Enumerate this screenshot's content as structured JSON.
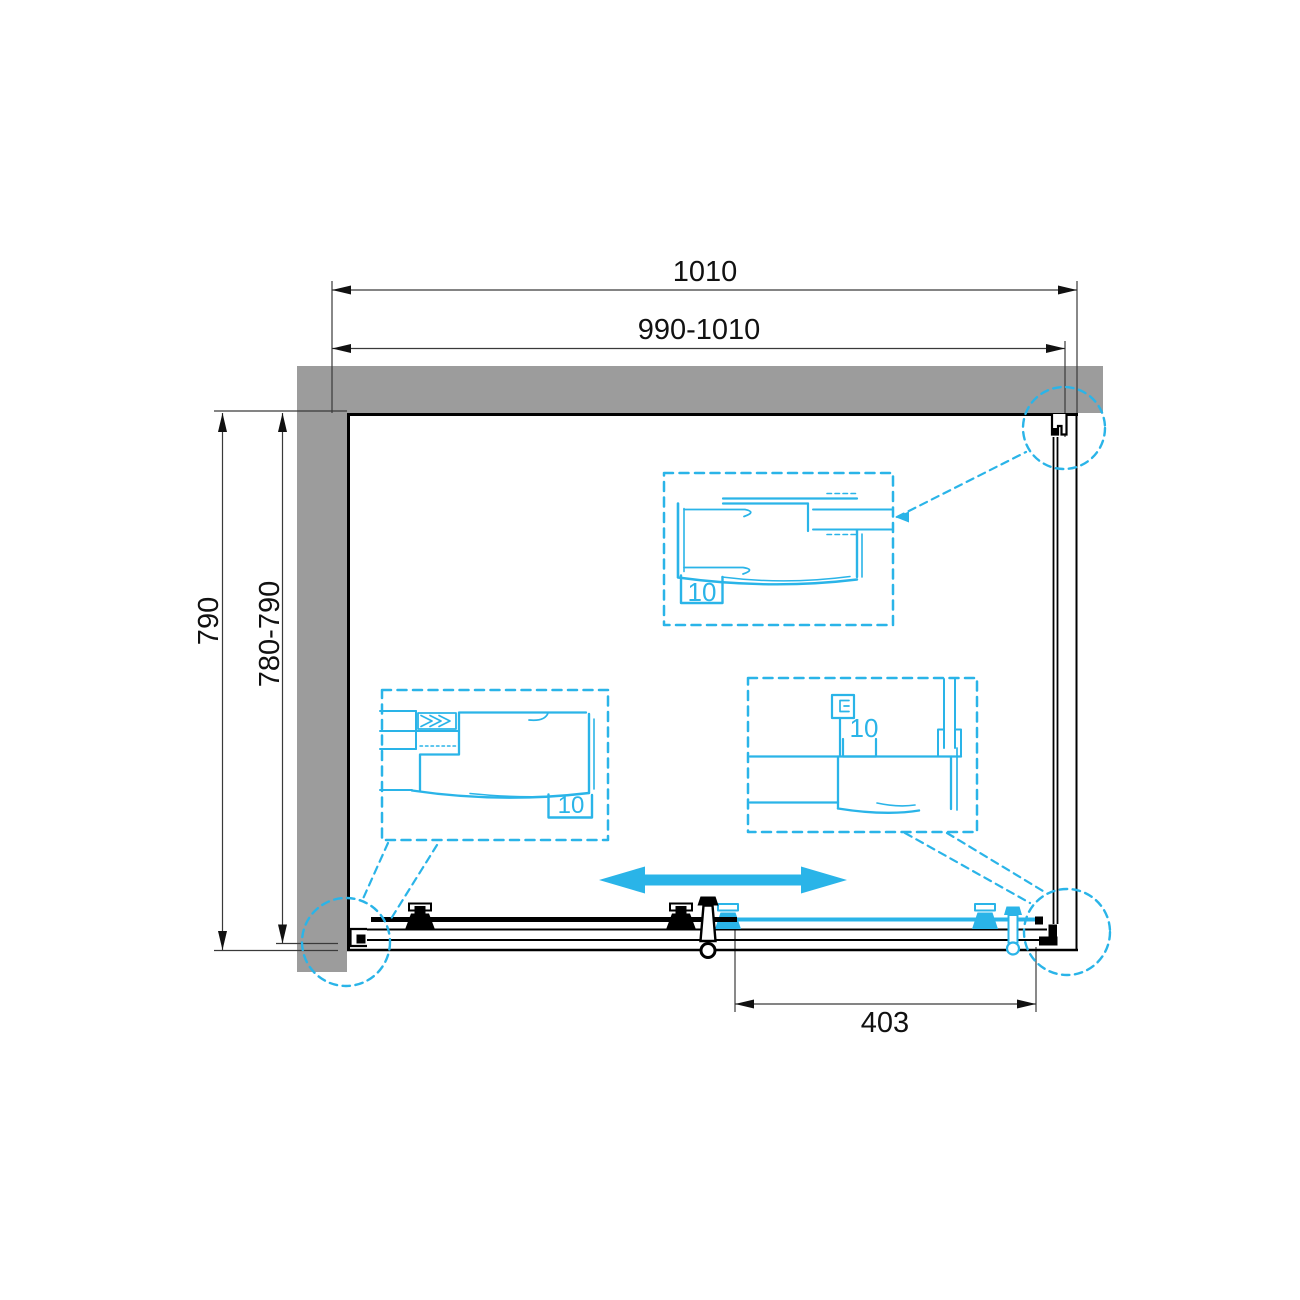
{
  "labels": {
    "dim_top_outer": "1010",
    "dim_top_range": "990-1010",
    "dim_left_outer": "790",
    "dim_left_range": "780-790",
    "dim_door_opening": "403",
    "detail_top_glass": "10",
    "detail_left_glass": "10",
    "detail_right_glass": "10"
  },
  "colors": {
    "accent": "#2AB4E8",
    "wall": "#9C9C9C",
    "line": "#000000",
    "dim": "#3A3A3A"
  },
  "icons": {
    "slide_direction": "double-headed-horizontal-arrow"
  }
}
